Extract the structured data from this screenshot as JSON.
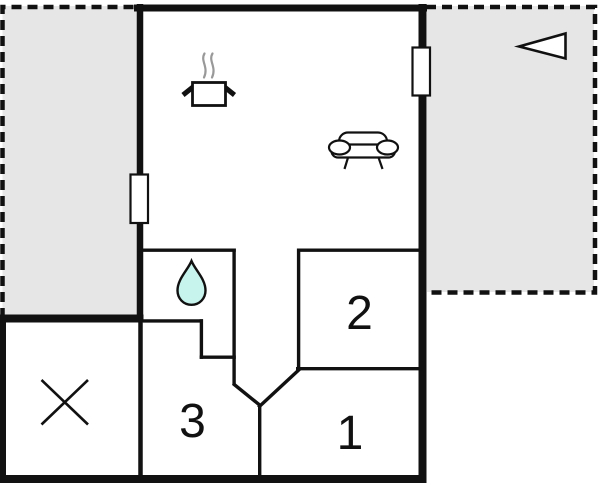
{
  "plan": {
    "type": "floor-plan",
    "rooms": [
      {
        "id": "room-1",
        "label": "1"
      },
      {
        "id": "room-2",
        "label": "2"
      },
      {
        "id": "room-3",
        "label": "3"
      }
    ],
    "icons": {
      "cooking_pot": "cooking-pot-icon",
      "steam": "steam-icon",
      "sofa": "sofa-icon",
      "water_drop": "water-drop-icon",
      "cross": "crossed-area-icon",
      "entrance_arrow": "entrance-arrow-icon",
      "window": "window-marker"
    },
    "colors": {
      "wall": "#111111",
      "terrace_fill": "#e6e6e6",
      "room_fill": "#ffffff",
      "drop_fill": "#c8f4ee",
      "steam": "#999999",
      "background": "#ffffff"
    }
  }
}
